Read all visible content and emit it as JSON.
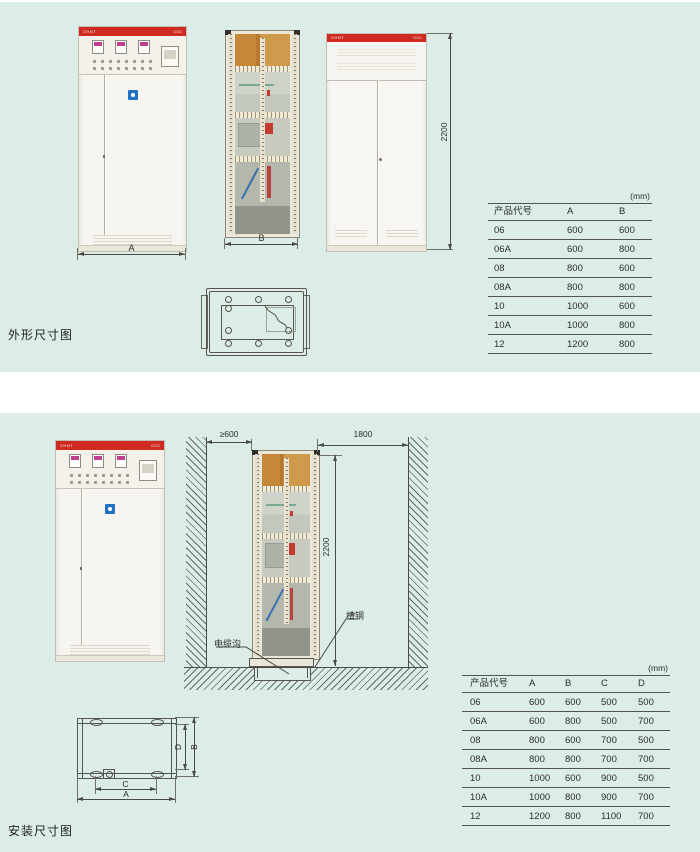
{
  "colors": {
    "panel_bg": "#dcede7",
    "accent_red": "#cf2a21",
    "meter_magenta": "#c23e8e",
    "badge_blue": "#2272c3",
    "line": "#4a4a46"
  },
  "outline": {
    "caption": "外形尺寸图",
    "brand": "CHNT",
    "model": "GGD",
    "dims": {
      "width": "A",
      "depth": "B",
      "height": "2200"
    },
    "table": {
      "unit": "(mm)",
      "headers": [
        "产品代号",
        "A",
        "B"
      ],
      "rows": [
        [
          "06",
          "600",
          "600"
        ],
        [
          "06A",
          "600",
          "800"
        ],
        [
          "08",
          "800",
          "600"
        ],
        [
          "08A",
          "800",
          "800"
        ],
        [
          "10",
          "1000",
          "600"
        ],
        [
          "10A",
          "1000",
          "800"
        ],
        [
          "12",
          "1200",
          "800"
        ]
      ]
    }
  },
  "install": {
    "caption": "安装尺寸图",
    "dims": {
      "left_clearance": "≥600",
      "rear_clearance": "1800",
      "height": "2200"
    },
    "callouts": {
      "channel_steel": "槽钢",
      "cable_trench": "电缆沟"
    },
    "plan": {
      "a": "A",
      "b": "B",
      "c": "C",
      "d": "D"
    },
    "table": {
      "unit": "(mm)",
      "headers": [
        "产品代号",
        "A",
        "B",
        "C",
        "D"
      ],
      "rows": [
        [
          "06",
          "600",
          "600",
          "500",
          "500"
        ],
        [
          "06A",
          "600",
          "800",
          "500",
          "700"
        ],
        [
          "08",
          "800",
          "600",
          "700",
          "500"
        ],
        [
          "08A",
          "800",
          "800",
          "700",
          "700"
        ],
        [
          "10",
          "1000",
          "600",
          "900",
          "500"
        ],
        [
          "10A",
          "1000",
          "800",
          "900",
          "700"
        ],
        [
          "12",
          "1200",
          "800",
          "1100",
          "700"
        ]
      ]
    }
  }
}
